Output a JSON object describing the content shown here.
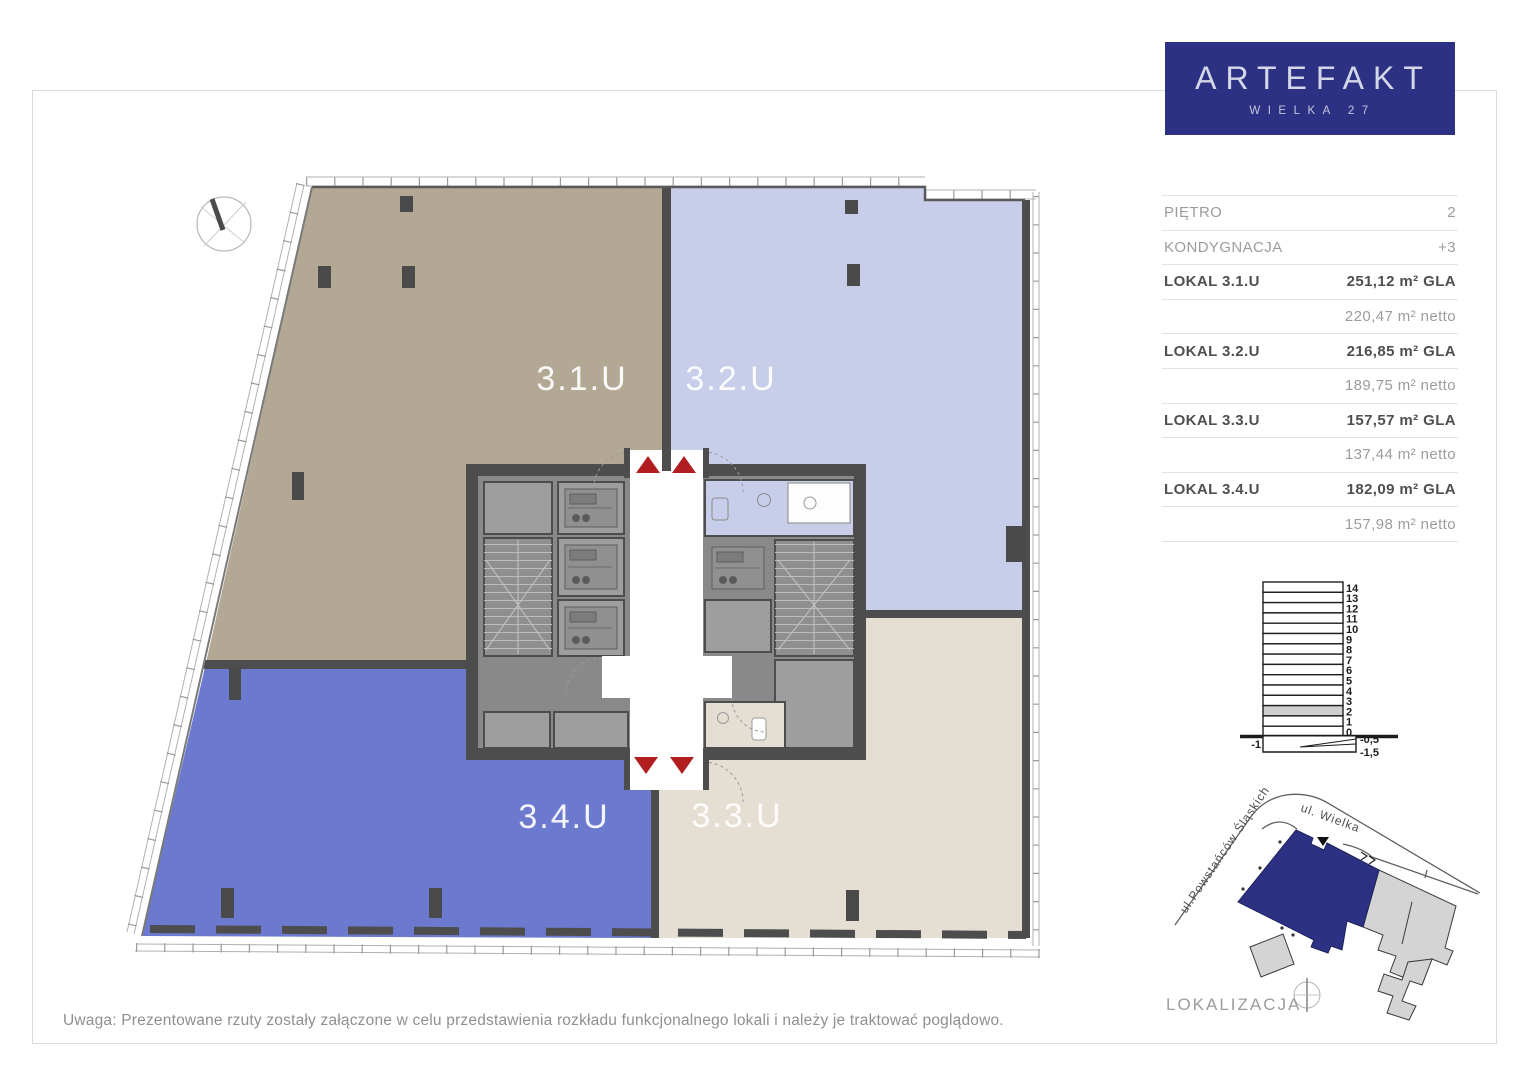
{
  "logo": {
    "title": "ARTEFAKT",
    "subtitle": "WIELKA 27"
  },
  "sidebar": {
    "rows": [
      {
        "label": "PIĘTRO",
        "value": "2",
        "bold": false
      },
      {
        "label": "KONDYGNACJA",
        "value": "+3",
        "bold": false
      },
      {
        "label": "LOKAL 3.1.U",
        "value": "251,12 m² GLA",
        "bold": true
      },
      {
        "label": "",
        "value": "220,47 m² netto",
        "bold": false
      },
      {
        "label": "LOKAL 3.2.U",
        "value": "216,85 m² GLA",
        "bold": true
      },
      {
        "label": "",
        "value": "189,75 m² netto",
        "bold": false
      },
      {
        "label": "LOKAL 3.3.U",
        "value": "157,57 m² GLA",
        "bold": true
      },
      {
        "label": "",
        "value": "137,44 m² netto",
        "bold": false
      },
      {
        "label": "LOKAL 3.4.U",
        "value": "182,09 m² GLA",
        "bold": true
      },
      {
        "label": "",
        "value": "157,98 m² netto",
        "bold": false
      }
    ]
  },
  "floor_plan": {
    "units": [
      {
        "label": "3.1.U"
      },
      {
        "label": "3.2.U"
      },
      {
        "label": "3.4.U"
      },
      {
        "label": "3.3.U"
      }
    ]
  },
  "cross_section": {
    "floors": [
      "14",
      "13",
      "12",
      "11",
      "10",
      "9",
      "8",
      "7",
      "6",
      "5",
      "4",
      "3",
      "2",
      "1",
      "0"
    ],
    "highlighted_floor": "2",
    "below_ground": {
      "left": "-1",
      "right_upper": "-0,5",
      "right_lower": "-1,5"
    }
  },
  "map": {
    "street_1": "ul.Powstańców Śląskich",
    "street_2": "ul.  Wielka",
    "caption": "LOKALIZACJA"
  },
  "note": "Uwaga: Prezentowane rzuty zostały załączone w celu przedstawienia rozkładu funkcjonalnego lokali i należy je traktować poglądowo.",
  "colors": {
    "navy": "#2d3184",
    "unit_31": "#b2a893",
    "unit_32": "#c8cee9",
    "unit_33": "#e5dfd3",
    "unit_34": "#6b79ce",
    "wall": "#4d4d4d",
    "core_fill": "#898989",
    "core_room": "#9e9e9e",
    "red_marker": "#b01e22",
    "map_neighbor": "#d4d4d4"
  }
}
